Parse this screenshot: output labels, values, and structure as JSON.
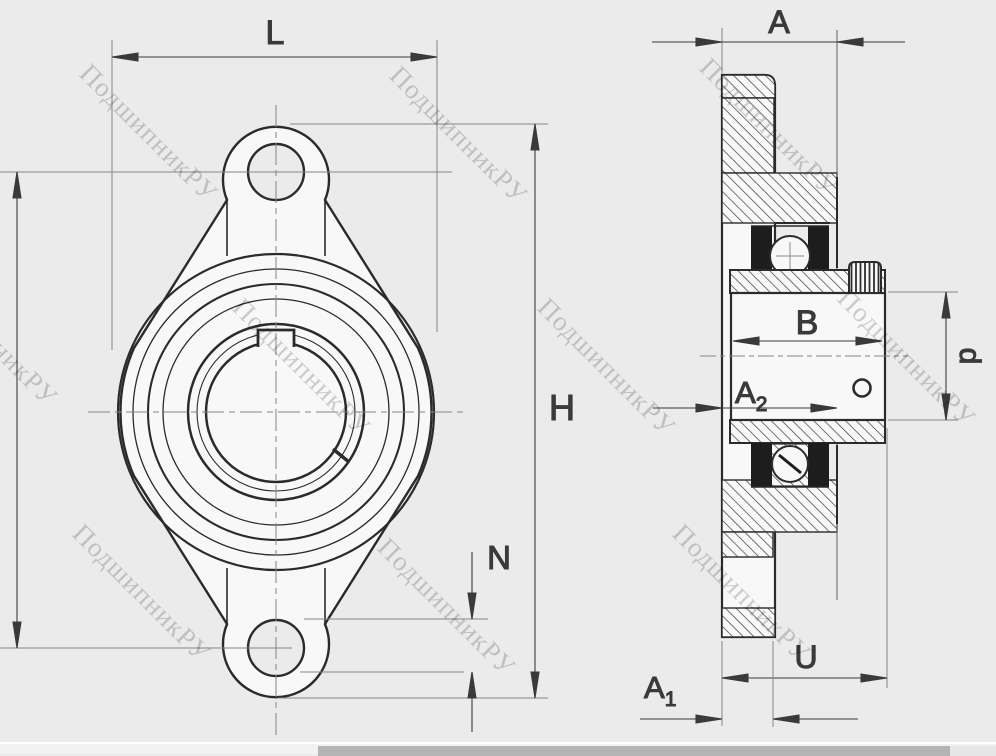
{
  "app": {
    "type": "technical-drawing",
    "subject": "oval two-bolt flange bearing unit, front view and sectional side view"
  },
  "watermark": {
    "text": "ПодшипникРУ",
    "color": "#b5b5b5",
    "instances": [
      {
        "x": 95,
        "y": 58
      },
      {
        "x": 405,
        "y": 60
      },
      {
        "x": 715,
        "y": 52
      },
      {
        "x": -65,
        "y": 262
      },
      {
        "x": 248,
        "y": 292
      },
      {
        "x": 553,
        "y": 292
      },
      {
        "x": 853,
        "y": 283
      },
      {
        "x": 88,
        "y": 518
      },
      {
        "x": 393,
        "y": 532
      },
      {
        "x": 688,
        "y": 518
      }
    ]
  },
  "dims": {
    "L": "L",
    "H": "H",
    "N": "N",
    "A": "A",
    "B": "B",
    "U": "U",
    "d": "d",
    "A1_base": "A",
    "A1_sub": "1",
    "A2_base": "A",
    "A2_sub": "2"
  },
  "colors": {
    "background": "#ebebeb",
    "metal_fill": "#f8f8f8",
    "outline": "#2b2b2b",
    "dimension": "#3a3a3a",
    "extension": "#858585",
    "watermark": "#b5b5b5",
    "scrollbar_track": "#f2f2f2",
    "scrollbar_thumb": "#b4b4b4"
  },
  "scrollbar": {
    "orientation": "horizontal",
    "thumb_start_px": 318,
    "thumb_end_px": 950
  }
}
